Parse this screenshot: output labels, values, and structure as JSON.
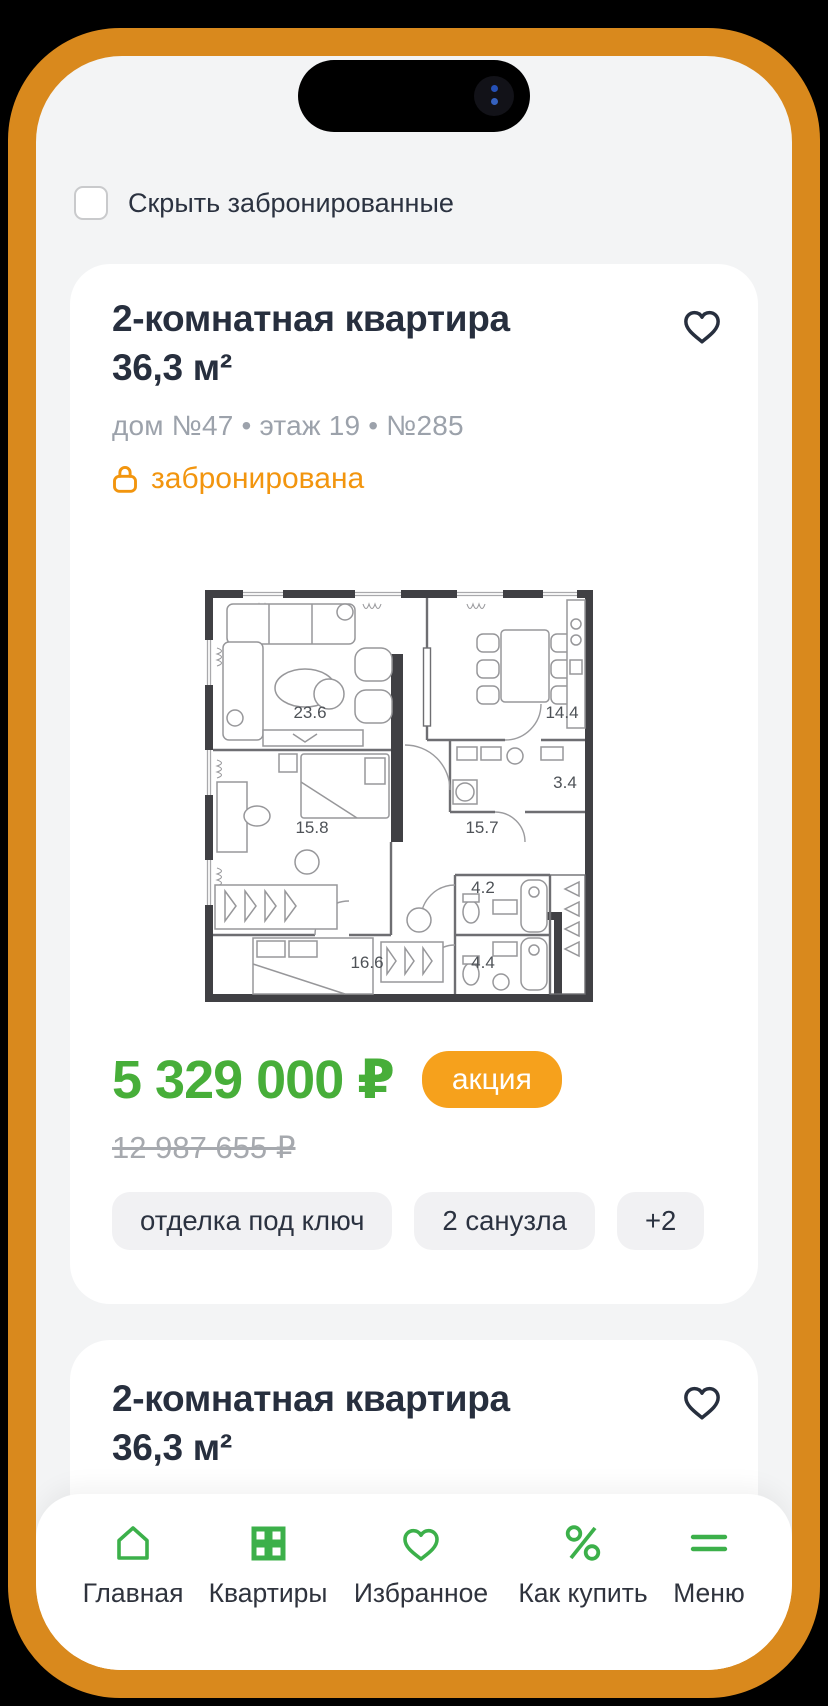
{
  "filters": {
    "hide_booked_label": "Скрыть забронированные",
    "hide_booked_checked": false
  },
  "cards": [
    {
      "title_line1": "2-комнатная квартира",
      "title_line2": "36,3 м²",
      "meta": "дом №47  •  этаж 19  •  №285",
      "status": "забронирована",
      "plan_rooms": [
        "23.6",
        "14.4",
        "3.4",
        "15.8",
        "15.7",
        "4.2",
        "16.6",
        "4.4"
      ],
      "price": "5 329 000 ₽",
      "badge": "акция",
      "old_price": "12 987 655 ₽",
      "tags": [
        "отделка под ключ",
        "2 санузла",
        "+2"
      ]
    },
    {
      "title_line1": "2-комнатная квартира",
      "title_line2": "36,3 м²"
    }
  ],
  "nav": {
    "items": [
      {
        "icon": "home-icon",
        "label": "Главная"
      },
      {
        "icon": "grid-icon",
        "label": "Квартиры"
      },
      {
        "icon": "heart-icon",
        "label": "Избранное"
      },
      {
        "icon": "percent-icon",
        "label": "Как купить"
      },
      {
        "icon": "menu-icon",
        "label": "Меню"
      }
    ]
  },
  "colors": {
    "bezel_orange": "#D9891D",
    "accent_orange": "#F6A11C",
    "status_orange": "#F2950E",
    "price_green": "#47AE39",
    "nav_green": "#3CB04A",
    "text_dark": "#272F3E",
    "text_gray": "#9CA2AB"
  }
}
